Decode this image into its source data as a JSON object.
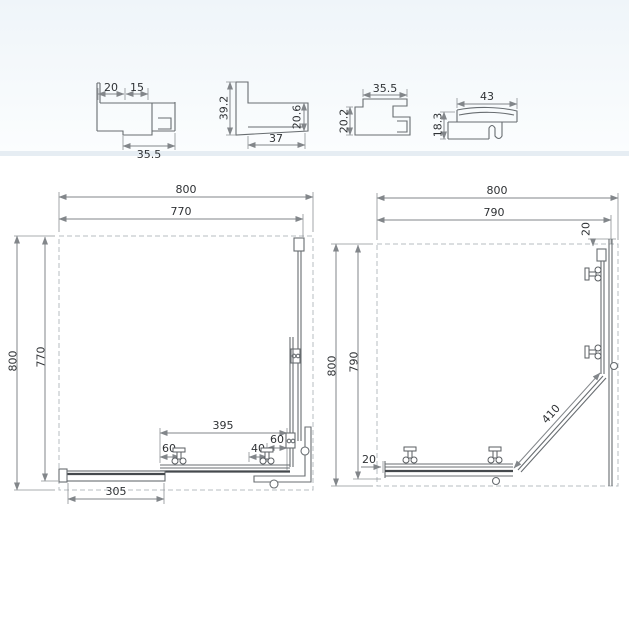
{
  "profile_sections": {
    "p1": {
      "top_left": "20",
      "top_right": "15",
      "bottom": "35.5"
    },
    "p2": {
      "left": "39.2",
      "right": "20.6",
      "bottom": "37"
    },
    "p3": {
      "top": "35.5",
      "left": "20.2"
    },
    "p4": {
      "top": "43",
      "left": "18.3"
    }
  },
  "plan_closed": {
    "top_outer": "800",
    "top_inner": "770",
    "left_outer": "800",
    "left_inner": "770",
    "bottom_panel": "395",
    "roller_left": "60",
    "roller_mid": "40",
    "roller_right": "60",
    "door": "305"
  },
  "plan_open": {
    "top_outer": "800",
    "top_inner": "790",
    "left_outer": "800",
    "left_inner": "790",
    "top_right_gap": "20",
    "diagonal_door": "410",
    "bottom_left_gap": "20"
  }
}
